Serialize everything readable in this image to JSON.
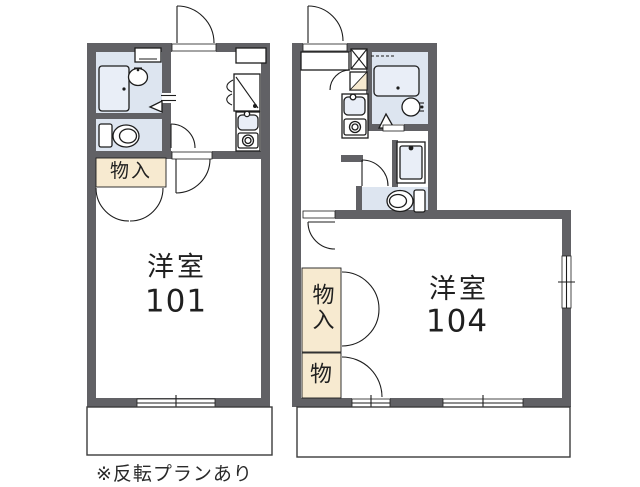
{
  "title": "floor-plan",
  "colors": {
    "wall": "#616165",
    "wet_floor": "#dde5f0",
    "fixture_fill": "#e9eef7",
    "storage_fill": "#f7ead0",
    "line": "#1d1d1d",
    "background": "#ffffff"
  },
  "unit101": {
    "room_type": "洋室",
    "room_number": "101",
    "storage_label": "物入"
  },
  "unit104": {
    "room_type": "洋室",
    "room_number": "104",
    "storage_main_label": "物入",
    "storage_sub_label": "物"
  },
  "footnote": "※反転プランあり",
  "icons": {
    "bathtub-icon": "rounded rectangle with drain dot",
    "washbasin-icon": "circle with tap marks",
    "toilet-icon": "oval bowl with tank",
    "kitchen-sink-icon": "rounded rect with faucet dot",
    "stove-icon": "square with burner ring",
    "washing-machine-icon": "square with inlet dot",
    "pipe-shaft-icon": "square with X",
    "door-swing-arc": "quarter circle",
    "window": "double line in wall"
  }
}
